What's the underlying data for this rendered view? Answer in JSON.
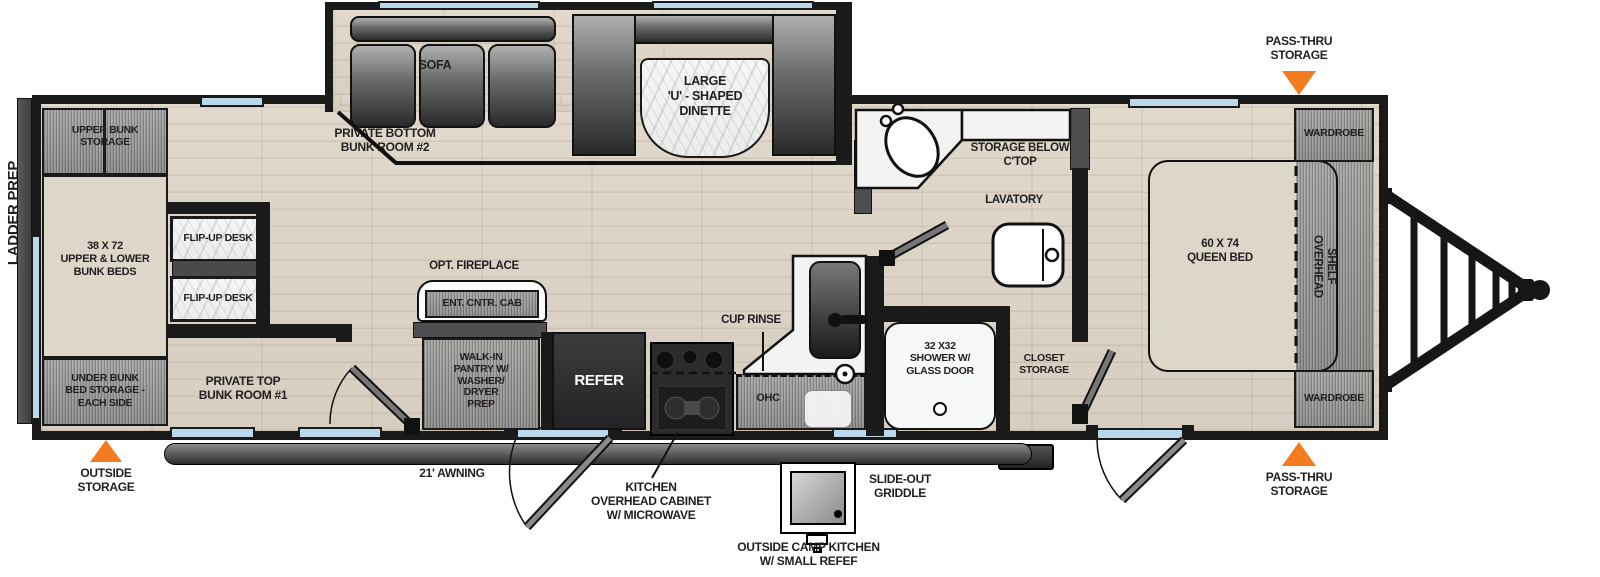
{
  "colors": {
    "accent": "#f47b20",
    "wall": "#1a1a1a",
    "window": "#b9d8e9",
    "beige": "#ddd7ca",
    "floor": "#dcd4c6",
    "graywood": "#9b9b99",
    "marble": "#f3f3f1",
    "dark_furniture": "#2e2e30"
  },
  "labels": {
    "ladder_prep": "LADDER PREP",
    "upper_bunk_storage": "UPPER BUNK\nSTORAGE",
    "bunk_beds": "38 X 72\nUPPER & LOWER\nBUNK BEDS",
    "under_bunk_storage": "UNDER BUNK\nBED STORAGE -\nEACH SIDE",
    "bunk_room2": "PRIVATE BOTTOM\nBUNK ROOM #2",
    "bunk_room1": "PRIVATE TOP\nBUNK ROOM #1",
    "flip_up_desk_1": "FLIP-UP DESK",
    "flip_up_desk_2": "FLIP-UP DESK",
    "sofa": "SOFA",
    "dinette": "LARGE\n'U' - SHAPED\nDINETTE",
    "opt_fireplace": "OPT. FIREPLACE",
    "ent_cntr_cab": "ENT. CNTR. CAB",
    "pantry": "WALK-IN\nPANTRY W/\nWASHER/\nDRYER\nPREP",
    "refer": "REFER",
    "ohc": "OHC",
    "cup_rinse": "CUP RINSE",
    "storage_below_ctop": "STORAGE BELOW\nC'TOP",
    "lavatory": "LAVATORY",
    "shower": "32 X32\nSHOWER W/\nGLASS DOOR",
    "closet_storage": "CLOSET\nSTORAGE",
    "queen_bed": "60 X 74\nQUEEN BED",
    "wardrobe_top": "WARDROBE",
    "wardrobe_bottom": "WARDROBE",
    "overhead_shelf": "OVERHEAD\nSHELF",
    "pass_thru_top": "PASS-THRU\nSTORAGE",
    "pass_thru_bottom": "PASS-THRU\nSTORAGE",
    "outside_storage": "OUTSIDE\nSTORAGE",
    "awning": "21' AWNING",
    "kitchen_ohc": "KITCHEN\nOVERHEAD CABINET\nW/ MICROWAVE",
    "slide_out_griddle": "SLIDE-OUT\nGRIDDLE",
    "outside_camp_kitchen": "OUTSIDE CAMP KITCHEN\nW/ SMALL REFEF"
  }
}
